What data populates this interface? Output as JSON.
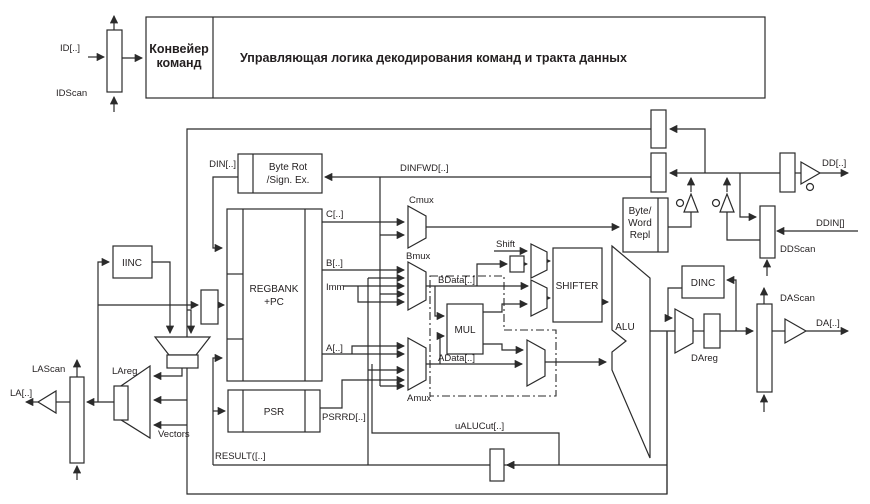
{
  "diagram_title": "ARM processor core datapath block diagram",
  "colors": {
    "line": "#2b2b2b",
    "background": "#ffffff"
  },
  "labels": {
    "id": "ID[..]",
    "idscan": "IDScan",
    "pipeline1": "Конвейер",
    "pipeline2": "команд",
    "control": "Управляющая логика декодирования команд и тракта данных",
    "din": "DIN[..]",
    "byterot1": "Byte Rot",
    "byterot2": "/Sign. Ex.",
    "dinfwd": "DINFWD[..]",
    "c": "C[..]",
    "cmux": "Cmux",
    "b": "B[..]",
    "imm": "Imm",
    "bmux": "Bmux",
    "bdata": "BData[..]",
    "shift": "Shift",
    "shifter": "SHIFTER",
    "bw1": "Byte/",
    "bw2": "Word",
    "bw3": "Repl",
    "dd": "DD[..]",
    "ddin": "DDIN[]",
    "ddscan": "DDScan",
    "iinc": "IINC",
    "regbank1": "REGBANK",
    "regbank2": "+PC",
    "a": "A[..]",
    "amux": "Amux",
    "adata": "AData[..]",
    "mul": "MUL",
    "alu": "ALU",
    "dinc": "DINC",
    "dareg": "DAreg",
    "dascan": "DAScan",
    "da": "DA[..]",
    "lascan": "LAScan",
    "la": "LA[..]",
    "lareg": "LAreg",
    "vectors": "Vectors",
    "psr": "PSR",
    "psrrd": "PSRRD[..]",
    "ualucut": "uALUCut[..]",
    "result": "RESULT([..]"
  }
}
